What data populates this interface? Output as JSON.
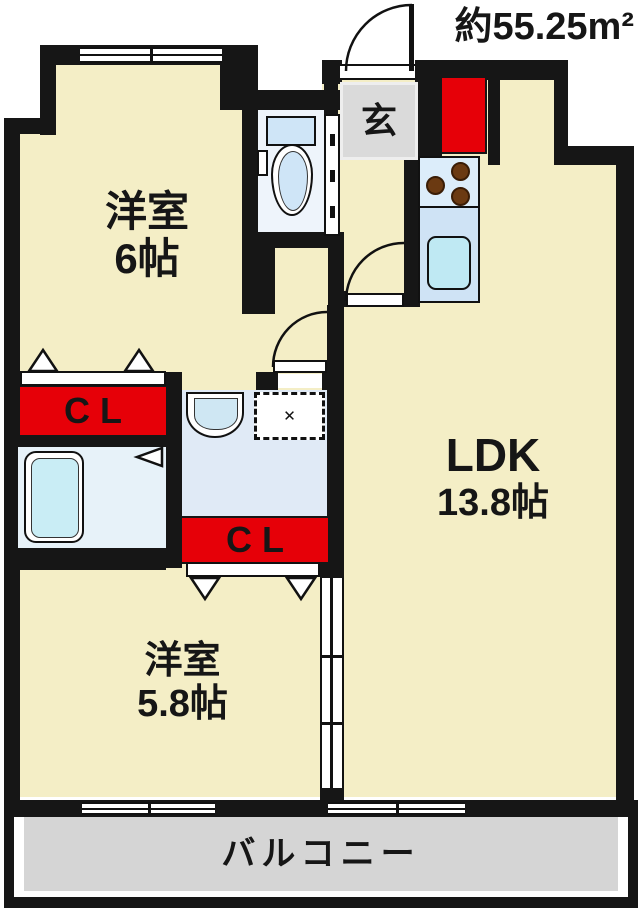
{
  "title": {
    "area_label": "約55.25m²"
  },
  "entrance": {
    "label": "玄"
  },
  "rooms": {
    "western1": {
      "name": "洋室",
      "size": "6帖"
    },
    "ldk": {
      "name": "LDK",
      "size": "13.8帖"
    },
    "western2": {
      "name": "洋室",
      "size": "5.8帖"
    },
    "balcony": {
      "label": "バルコニー"
    }
  },
  "closets": {
    "cl1": "CL",
    "cl2": "CL"
  },
  "icons": {
    "washing_machine_pan_mark": "✕"
  },
  "colors": {
    "wall": "#161616",
    "room_cream": "#f4eec6",
    "closet_red": "#e60008",
    "entrance_gray": "#dadada",
    "balcony_gray": "#d5d5d5",
    "fixture_blue": "#cfe5f7",
    "bathtub_blue": "#c9edf5"
  }
}
